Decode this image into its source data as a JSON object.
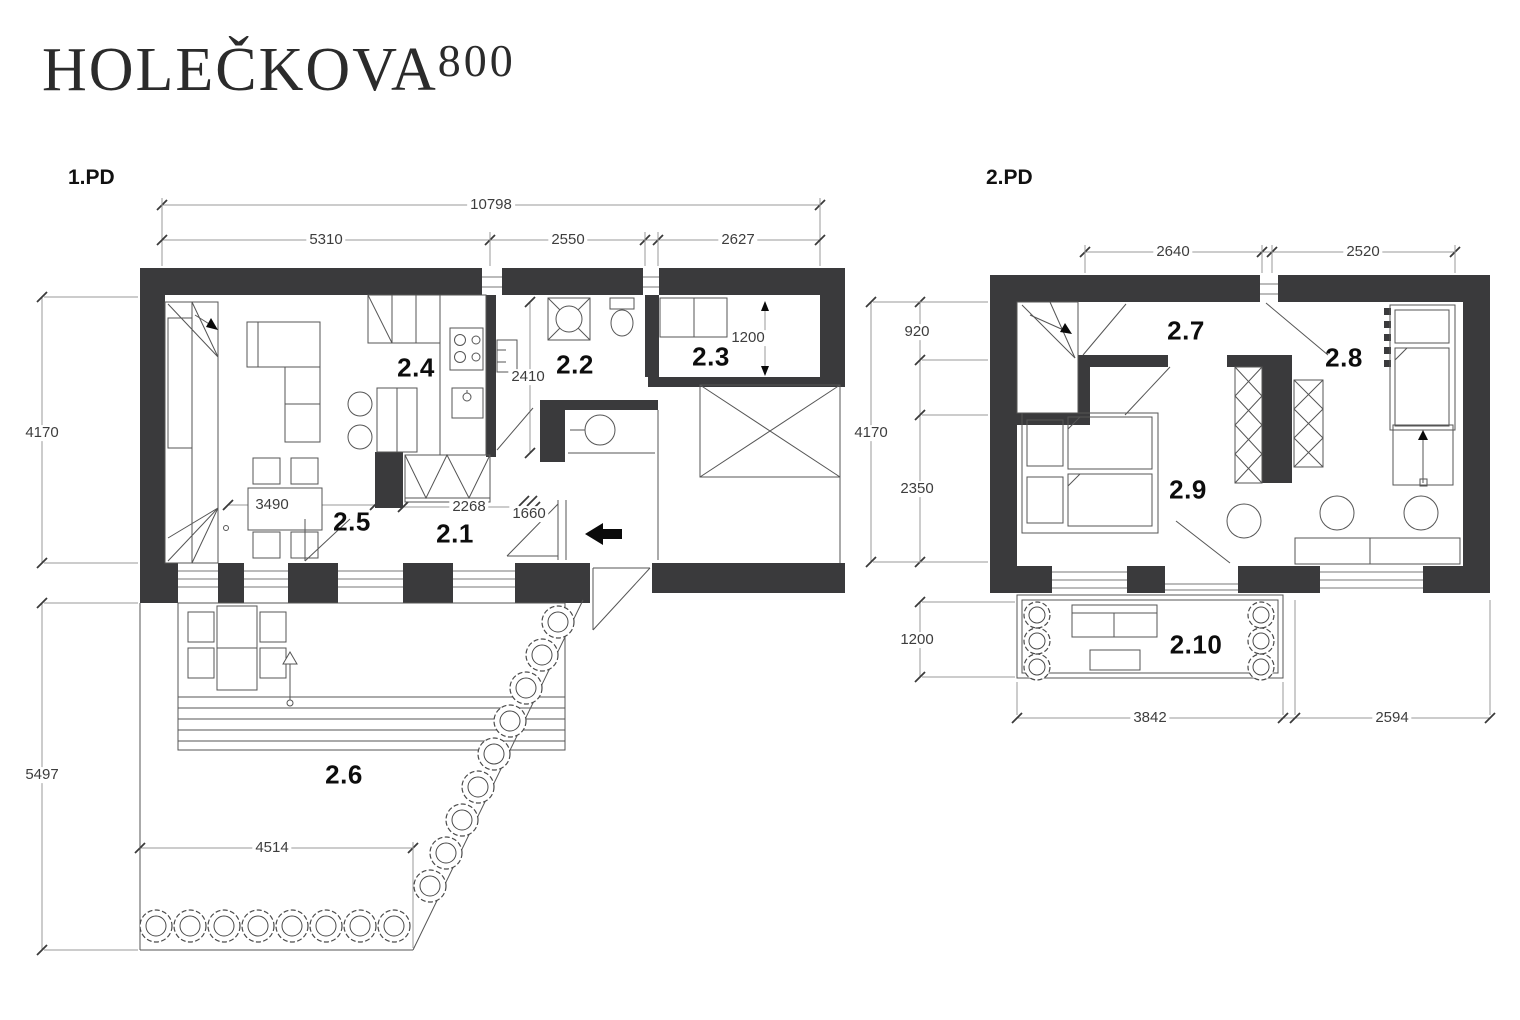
{
  "title": {
    "name": "HOLEČKOVA",
    "number": "800"
  },
  "plan1": {
    "label": "1.PD",
    "rooms": {
      "r21": "2.1",
      "r22": "2.2",
      "r23": "2.3",
      "r24": "2.4",
      "r25": "2.5",
      "r26": "2.6"
    },
    "dims": {
      "total": "10798",
      "seg1": "5310",
      "seg2": "2550",
      "seg3": "2627",
      "left_upper": "4170",
      "left_lower": "5497",
      "living": "3490",
      "hall": "2268",
      "entry": "1660",
      "bath": "2410",
      "closet": "1200",
      "garden": "4514"
    }
  },
  "plan2": {
    "label": "2.PD",
    "rooms": {
      "r27": "2.7",
      "r28": "2.8",
      "r29": "2.9",
      "r210": "2.10"
    },
    "dims": {
      "top1": "2640",
      "top2": "2520",
      "left_total": "4170",
      "left1": "920",
      "left2": "2350",
      "left3": "1200",
      "bottom1": "3842",
      "bottom2": "2594"
    }
  },
  "colors": {
    "wall": "#3a3a3c",
    "line": "#555555",
    "dim_line": "#999999",
    "text": "#0d0d0d"
  }
}
